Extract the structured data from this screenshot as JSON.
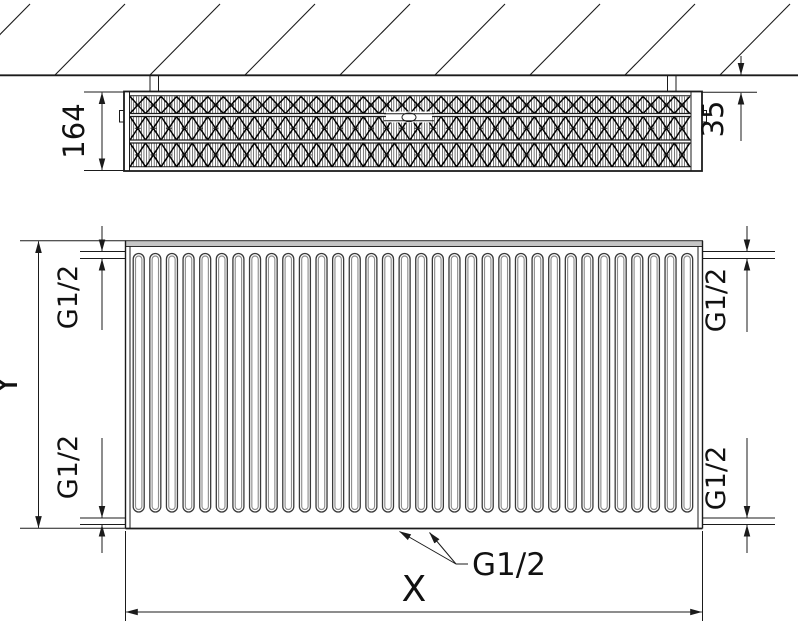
{
  "drawing": {
    "type": "panel-radiator-technical-drawing",
    "colors": {
      "line": "#1b1b1b",
      "channel_outer": "#3a3a3a",
      "channel_inner": "#8f8f8f",
      "top_band_fill": "#c6c6c6",
      "fin_line": "#101010",
      "background": "#ffffff"
    },
    "top_view": {
      "depth_dimension": {
        "label": "164"
      },
      "wall_gap_dimension": {
        "label": "35"
      },
      "fin_row_count": 3,
      "hatch_count": 9,
      "bracket_count": 2
    },
    "front_view": {
      "height_dimension": {
        "label": "Y"
      },
      "width_dimension": {
        "label": "X"
      },
      "channel_count": 34,
      "connections": {
        "top_left": "G1/2",
        "top_right": "G1/2",
        "bottom_left": "G1/2",
        "bottom_right": "G1/2",
        "bottom_center": "G1/2"
      }
    }
  }
}
